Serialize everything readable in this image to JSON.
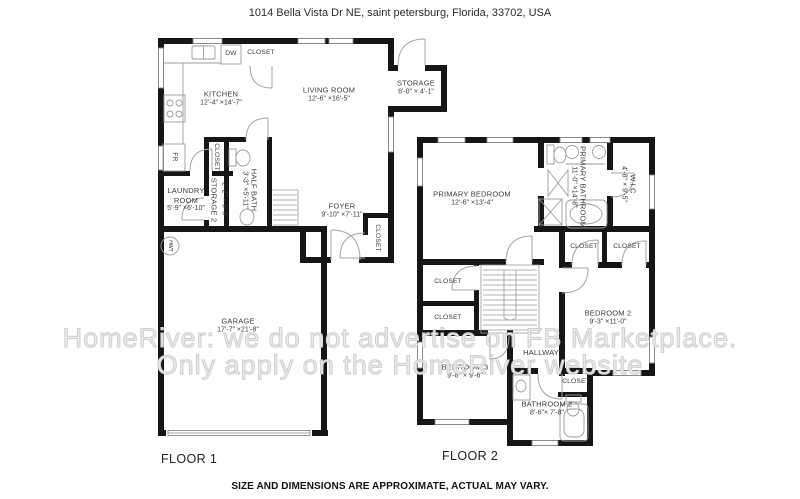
{
  "header": {
    "address": "1014 Bella Vista Dr NE, saint petersburg, Florida, 33702, USA"
  },
  "watermark": {
    "line1": "HomeRiver: we do not advertise on FB Marketplace.",
    "line2": "Only apply on the HomeRiver website"
  },
  "footer": {
    "disclaimer": "SIZE AND DIMENSIONS ARE APPROXIMATE, ACTUAL MAY VARY."
  },
  "floor1": {
    "label": "FLOOR 1",
    "rooms": {
      "kitchen": {
        "name": "KITCHEN",
        "dims": "12'-4\" ×14'-7\""
      },
      "living_room": {
        "name": "LIVING ROOM",
        "dims": "12'-6\" ×16'-5\""
      },
      "storage": {
        "name": "STORAGE",
        "dims": "6'-0\" × 4'-1\""
      },
      "half_bath": {
        "name": "HALF BATH",
        "dims": "3'-3\" ×5'-11\""
      },
      "storage2": {
        "name": "STORAGE 2",
        "dims": "2'-2\" × 6'-9\""
      },
      "laundry": {
        "name1": "LAUNDRY",
        "name2": "ROOM",
        "dims": "5'-9\" ×6'-10\""
      },
      "foyer": {
        "name": "FOYER",
        "dims": "9'-10\" ×7'-11\""
      },
      "garage": {
        "name": "GARAGE",
        "dims": "17'-7\" ×21'-8\""
      }
    },
    "labels": {
      "dw": "DW",
      "fr": "FR",
      "hwt": "HWT",
      "closet_kitchen": "CLOSET",
      "closet_hall": "CLOSET",
      "closet_foyer": "CLOSET"
    }
  },
  "floor2": {
    "label": "FLOOR 2",
    "rooms": {
      "primary_bedroom": {
        "name": "PRIMARY BEDROOM",
        "dims": "12'-6\" ×13'-4\""
      },
      "primary_bathroom": {
        "name": "PRIMARY BATHROOM",
        "dims": "11'-0\" ×14'-8\""
      },
      "wic": {
        "name": "W.I.C",
        "dims": "4'-8\" × 9'-5\""
      },
      "bedroom2": {
        "name": "BEDROOM 2",
        "dims": "9'-3\" ×11'-0\""
      },
      "bedroom3": {
        "name": "BEDROOM 3",
        "dims": "9'-8\" × 9'-6\""
      },
      "bathroom2": {
        "name": "BATHROOM 2",
        "dims": "8'-6\"× 7'-8\""
      },
      "hallway": {
        "name": "HALLWAY"
      }
    },
    "labels": {
      "closet_a": "CLOSET",
      "closet_b": "CLOSET",
      "closet_c": "CLOSET",
      "closet_d": "CLOSET",
      "closet_bath": "CLOSET"
    }
  }
}
